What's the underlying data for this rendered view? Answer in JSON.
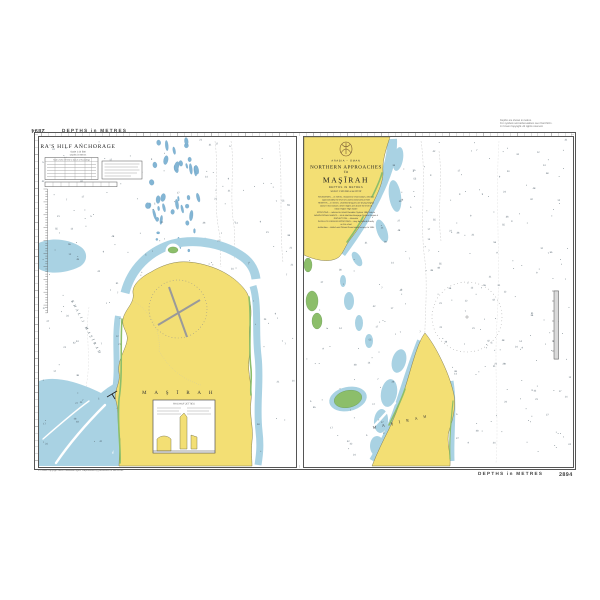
{
  "chart_sheet": {
    "number": "2894",
    "top_margin_label": "DEPTHS in METRES",
    "bottom_margin_label": "DEPTHS in METRES",
    "top_right_notes": [
      "Depths are shown in metres.",
      "For symbols and abbreviations see Chart 5011.",
      "© Crown Copyright. All rights reserved."
    ],
    "bottom_left_note": "© Crown Copyright and/or database rights. Reproduced by permission of the UKHO.",
    "bottom_center_note": "Natural Scale 1:100 000"
  },
  "left_panel": {
    "title": "RA'S HILF ANCHORAGE",
    "subtitle1": "Scale 1:12 500",
    "subtitle2": "Depths in Metres",
    "tidal_table_title": "Tidal Levels referred to Datum of Soundings",
    "sea_label": "KHALIJ  MAŞĪRAH",
    "island_label": "M A Ş Ī R A H",
    "inset_title": "RA'S HILF JETTIES"
  },
  "right_panel": {
    "country_label": "ARABIA  –  OMAN",
    "title_line1": "NORTHERN APPROACHES",
    "title_line2": "TO",
    "title_line3": "MAŞĪRAH",
    "depths_label": "DEPTHS IN METRES",
    "scale_label": "SCALE 1:100 000 at lat 20°40'",
    "notes": [
      "SOUNDINGS.....in metres, reduced to Chart Datum, which is",
      "approximately the level of Lowest Astronomical Tide",
      "HEIGHTS.....in metres. Underlined figures are drying heights",
      "above Chart Datum; other heights are above the level of",
      "Mean Higher High Water",
      "POSITIONS.....referred to World Geodetic System 1984 Datum",
      "NAVIGATIONAL MARKS.....IALA Maritime Buoyage System Region A",
      "PROJECTION.....Mercator",
      "SATELLITE-DERIVED POSITIONS.....may be plotted directly",
      "on this chart",
      "Authorities.....British and Omani Government surveys to 1994"
    ],
    "island_label": "M A Ş Ī R A H"
  },
  "colors": {
    "sea_shallow": "#a9d2e3",
    "sea_patch": "#82b5d4",
    "land": "#f3df74",
    "green": "#8cbe6a",
    "ink": "#333333",
    "contour": "#c6c6c6",
    "sounding": "#4a5a66",
    "border": "#555555",
    "emblem": "#7a5a32"
  },
  "soundings": {
    "values": [
      "5",
      "7",
      "9",
      "12",
      "14",
      "17",
      "21",
      "24",
      "27",
      "31",
      "36",
      "42",
      "48",
      "55"
    ],
    "left_count": 240,
    "right_count": 290,
    "seed": 11
  }
}
